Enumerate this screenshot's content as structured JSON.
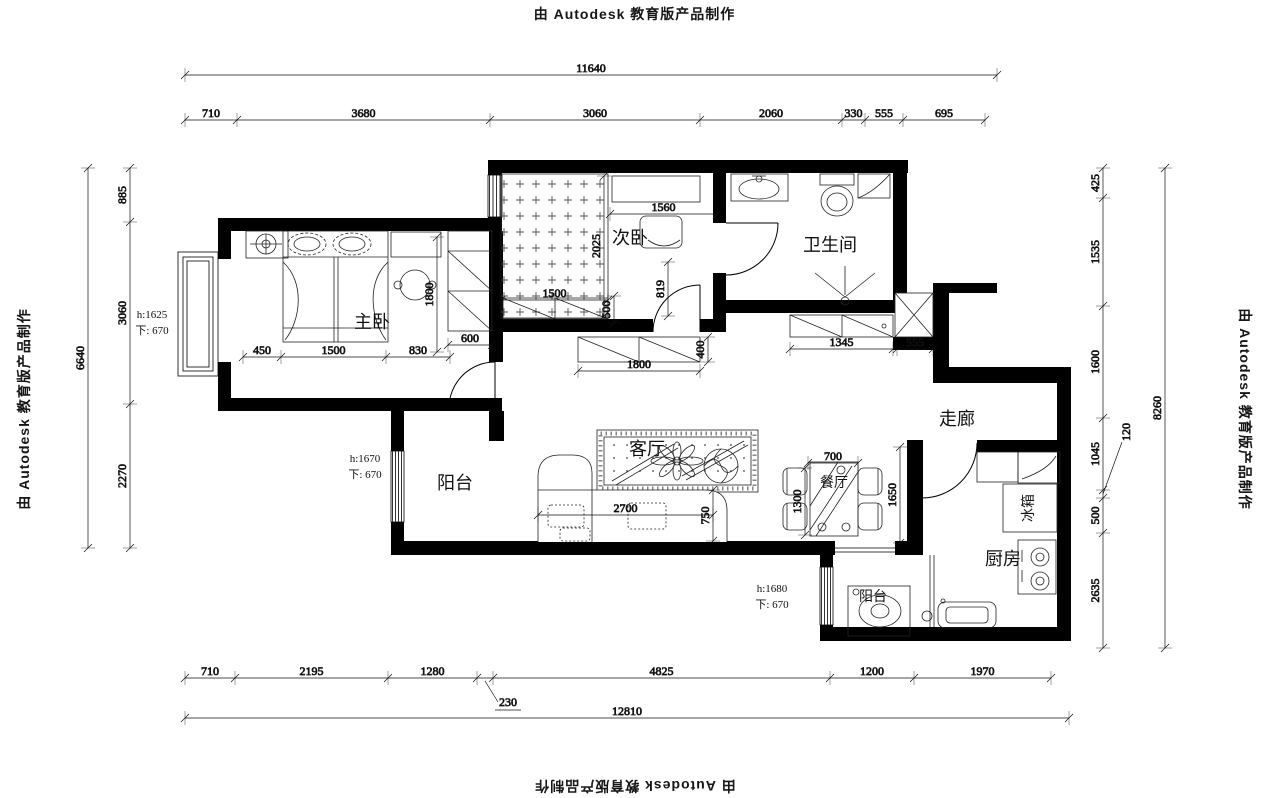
{
  "watermark": {
    "text": "由 Autodesk 教育版产品制作"
  },
  "rooms": {
    "master": "主卧",
    "second": "次卧",
    "bathroom": "卫生间",
    "corridor": "走廊",
    "balcony_left": "阳台",
    "balcony_bottom": "阳台",
    "living": "客厅",
    "dining": "餐厅",
    "kitchen": "厨房",
    "fridge": "冰箱"
  },
  "window_notes": {
    "master": {
      "h": "h:1625",
      "sill": "下: 670"
    },
    "balcony_left": {
      "h": "h:1670",
      "sill": "下: 670"
    },
    "balcony_bottom": {
      "h": "h:1680",
      "sill": "下: 670"
    }
  },
  "dims": {
    "top_total": [
      "11640"
    ],
    "top_segments": [
      "710",
      "3680",
      "3060",
      "2060",
      "330",
      "555",
      "695"
    ],
    "left_total": [
      "6640"
    ],
    "left_segments": [
      "885",
      "3060",
      "2270"
    ],
    "right_total": [
      "8260"
    ],
    "right_segments": [
      "425",
      "1535",
      "1600",
      "1045",
      "500",
      "2635"
    ],
    "right_leader": "120",
    "bottom_total": [
      "12810"
    ],
    "bottom_segments": [
      "710",
      "2195",
      "1280",
      "4825",
      "1200",
      "1970"
    ],
    "bottom_leader": "230"
  },
  "interior_dims": {
    "bed_450": "450",
    "bed_1500": "1500",
    "bed_830": "830",
    "master_1800": "1800",
    "wardrobe_600": "600",
    "second_1560": "1560",
    "second_2025": "2025",
    "tatami_1500": "1500",
    "cabinet_500": "500",
    "door_819": "819",
    "hall_cabinet_1800": "1800",
    "hall_cabinet_400": "400",
    "bath_cabinet_1345": "1345",
    "shaft_555": "555",
    "sofa_2700": "2700",
    "sofa_750": "750",
    "table_700": "700",
    "table_1300": "1300",
    "dining_1650": "1650"
  }
}
